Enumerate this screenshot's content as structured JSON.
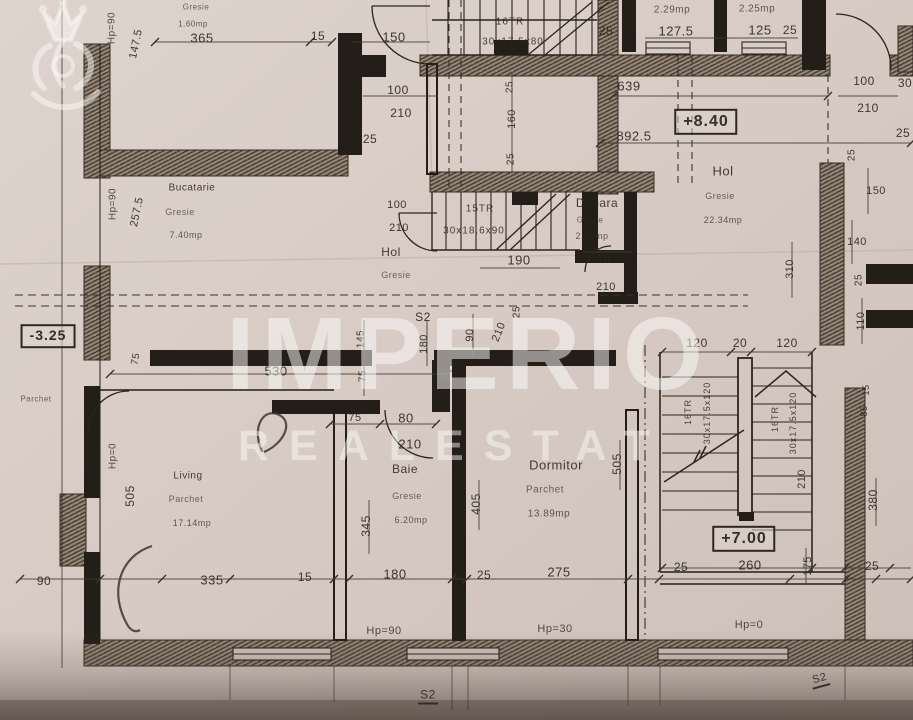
{
  "document": {
    "type": "scanned floor plan (etaj) photo"
  },
  "watermark": {
    "brand": "IMPERIO",
    "brand_sub": "REALESTAT",
    "logo": "crown-lion-icon"
  },
  "rooms": [
    {
      "name": "Bucatarie",
      "finish": "Gresie",
      "area": "7.40mp"
    },
    {
      "name": "Hol",
      "finish": "Gresie",
      "area": ""
    },
    {
      "name": "Debara",
      "finish": "Gresie",
      "area": "2.10mp"
    },
    {
      "name": "Hol",
      "finish": "Gresie",
      "area": "22.34mp"
    },
    {
      "name": "Living",
      "finish": "Parchet",
      "area": "17.14mp"
    },
    {
      "name": "Baie",
      "finish": "Gresie",
      "area": "6.20mp"
    },
    {
      "name": "Dormitor",
      "finish": "Parchet",
      "area": "13.89mp"
    }
  ],
  "elevations": [
    "+8.40",
    "+7.00",
    "-3.25"
  ],
  "stairs": [
    {
      "label": "16TR 30x17.5x80"
    },
    {
      "label": "15TR 30x18.6x90"
    },
    {
      "label": "16TR 30x17.5x120"
    },
    {
      "label": "16TR 30x17.5x120"
    }
  ],
  "labels": [
    {
      "t": "Hp=90",
      "x": 112,
      "y": 28,
      "r": -90,
      "s": 10,
      "c": "hp"
    },
    {
      "t": "147.5",
      "x": 136,
      "y": 44,
      "r": -78,
      "s": 11
    },
    {
      "t": "Gresie",
      "x": 196,
      "y": 7,
      "s": 8,
      "c": "fin"
    },
    {
      "t": "1.60mp",
      "x": 193,
      "y": 24,
      "s": 8,
      "c": "area"
    },
    {
      "t": "365",
      "x": 202,
      "y": 38,
      "s": 13
    },
    {
      "t": "15",
      "x": 318,
      "y": 36,
      "s": 12
    },
    {
      "t": "150",
      "x": 394,
      "y": 37,
      "s": 13
    },
    {
      "t": "16TR",
      "x": 510,
      "y": 22,
      "s": 10,
      "c": "stair"
    },
    {
      "t": "30x17.5x80",
      "x": 513,
      "y": 42,
      "s": 10,
      "c": "stair"
    },
    {
      "t": "25",
      "x": 606,
      "y": 31,
      "s": 12
    },
    {
      "t": "2.29mp",
      "x": 672,
      "y": 10,
      "s": 10,
      "c": "area"
    },
    {
      "t": "127.5",
      "x": 676,
      "y": 31,
      "s": 13
    },
    {
      "t": "2.25mp",
      "x": 757,
      "y": 9,
      "s": 10,
      "c": "area"
    },
    {
      "t": "125",
      "x": 760,
      "y": 30,
      "s": 13
    },
    {
      "t": "25",
      "x": 790,
      "y": 30,
      "s": 12
    },
    {
      "t": "100",
      "x": 398,
      "y": 90,
      "s": 12
    },
    {
      "t": "210",
      "x": 401,
      "y": 113,
      "s": 12
    },
    {
      "t": "25",
      "x": 370,
      "y": 139,
      "s": 12
    },
    {
      "t": "25",
      "x": 510,
      "y": 87,
      "r": -90,
      "s": 10
    },
    {
      "t": "160",
      "x": 512,
      "y": 119,
      "r": -90,
      "s": 11
    },
    {
      "t": "25",
      "x": 511,
      "y": 159,
      "r": -90,
      "s": 10
    },
    {
      "t": "639",
      "x": 629,
      "y": 86,
      "s": 13
    },
    {
      "t": "892.5",
      "x": 634,
      "y": 136,
      "s": 13
    },
    {
      "t": "+8.40",
      "x": 706,
      "y": 122,
      "s": 16,
      "c": "box"
    },
    {
      "t": "100",
      "x": 864,
      "y": 81,
      "s": 12
    },
    {
      "t": "30",
      "x": 905,
      "y": 83,
      "s": 12
    },
    {
      "t": "210",
      "x": 868,
      "y": 108,
      "s": 12
    },
    {
      "t": "25",
      "x": 903,
      "y": 133,
      "s": 12
    },
    {
      "t": "25",
      "x": 852,
      "y": 155,
      "r": -90,
      "s": 10
    },
    {
      "t": "Hol",
      "x": 723,
      "y": 171,
      "s": 13,
      "c": "room"
    },
    {
      "t": "Gresie",
      "x": 720,
      "y": 196,
      "s": 9,
      "c": "fin"
    },
    {
      "t": "22.34mp",
      "x": 723,
      "y": 220,
      "s": 9,
      "c": "area"
    },
    {
      "t": "150",
      "x": 876,
      "y": 191,
      "s": 11
    },
    {
      "t": "140",
      "x": 857,
      "y": 242,
      "s": 11
    },
    {
      "t": "310",
      "x": 790,
      "y": 269,
      "r": -90,
      "s": 11
    },
    {
      "t": "25",
      "x": 859,
      "y": 280,
      "r": -90,
      "s": 10
    },
    {
      "t": "110",
      "x": 861,
      "y": 321,
      "r": -90,
      "s": 11
    },
    {
      "t": "15TR",
      "x": 480,
      "y": 209,
      "s": 10,
      "c": "stair"
    },
    {
      "t": "30x18.6x90",
      "x": 474,
      "y": 231,
      "s": 10,
      "c": "stair"
    },
    {
      "t": "190",
      "x": 519,
      "y": 260,
      "s": 13
    },
    {
      "t": "Debara",
      "x": 597,
      "y": 203,
      "s": 12,
      "c": "room"
    },
    {
      "t": "Gresie",
      "x": 590,
      "y": 220,
      "s": 8,
      "c": "fin"
    },
    {
      "t": "2.10mp",
      "x": 592,
      "y": 236,
      "s": 9,
      "c": "area"
    },
    {
      "t": "70",
      "x": 604,
      "y": 259,
      "s": 11
    },
    {
      "t": "210",
      "x": 606,
      "y": 287,
      "s": 11
    },
    {
      "t": "Hol",
      "x": 391,
      "y": 252,
      "s": 12,
      "c": "room"
    },
    {
      "t": "Gresie",
      "x": 396,
      "y": 275,
      "s": 9,
      "c": "fin"
    },
    {
      "t": "100",
      "x": 397,
      "y": 205,
      "s": 11
    },
    {
      "t": "210",
      "x": 399,
      "y": 228,
      "s": 11
    },
    {
      "t": "S2",
      "x": 423,
      "y": 317,
      "s": 12,
      "c": "sec"
    },
    {
      "t": "180",
      "x": 424,
      "y": 344,
      "r": -90,
      "s": 11
    },
    {
      "t": "90",
      "x": 470,
      "y": 335,
      "r": -90,
      "s": 11
    },
    {
      "t": "210",
      "x": 499,
      "y": 332,
      "r": -68,
      "s": 11
    },
    {
      "t": "25",
      "x": 517,
      "y": 312,
      "r": -90,
      "s": 10
    },
    {
      "t": "145",
      "x": 361,
      "y": 339,
      "r": -90,
      "s": 10
    },
    {
      "t": "75",
      "x": 363,
      "y": 376,
      "r": -90,
      "s": 10
    },
    {
      "t": "530",
      "x": 276,
      "y": 371,
      "s": 13
    },
    {
      "t": "Hp=90",
      "x": 113,
      "y": 204,
      "r": -90,
      "s": 10,
      "c": "hp"
    },
    {
      "t": "257.5",
      "x": 137,
      "y": 212,
      "r": -78,
      "s": 11
    },
    {
      "t": "Bucatarie",
      "x": 192,
      "y": 188,
      "s": 10,
      "c": "room"
    },
    {
      "t": "Gresie",
      "x": 180,
      "y": 212,
      "s": 9,
      "c": "fin"
    },
    {
      "t": "7.40mp",
      "x": 186,
      "y": 235,
      "s": 9,
      "c": "area"
    },
    {
      "t": "-3.25",
      "x": 48,
      "y": 336,
      "s": 14,
      "c": "box"
    },
    {
      "t": "75",
      "x": 136,
      "y": 359,
      "r": -80,
      "s": 10
    },
    {
      "t": "Parchet",
      "x": 36,
      "y": 399,
      "s": 8,
      "c": "fin"
    },
    {
      "t": "Hp=0",
      "x": 113,
      "y": 456,
      "r": -90,
      "s": 10,
      "c": "hp"
    },
    {
      "t": "505",
      "x": 130,
      "y": 496,
      "r": -90,
      "s": 12
    },
    {
      "t": "Living",
      "x": 188,
      "y": 476,
      "s": 10,
      "c": "room"
    },
    {
      "t": "Parchet",
      "x": 186,
      "y": 499,
      "s": 9,
      "c": "fin"
    },
    {
      "t": "17.14mp",
      "x": 192,
      "y": 523,
      "s": 9,
      "c": "area"
    },
    {
      "t": "90",
      "x": 44,
      "y": 581,
      "s": 12
    },
    {
      "t": "335",
      "x": 212,
      "y": 580,
      "s": 13
    },
    {
      "t": "15",
      "x": 305,
      "y": 577,
      "s": 12
    },
    {
      "t": "75",
      "x": 355,
      "y": 418,
      "s": 11
    },
    {
      "t": "80",
      "x": 406,
      "y": 418,
      "s": 13
    },
    {
      "t": "210",
      "x": 410,
      "y": 444,
      "s": 13
    },
    {
      "t": "Baie",
      "x": 405,
      "y": 469,
      "s": 12,
      "c": "room"
    },
    {
      "t": "Gresie",
      "x": 407,
      "y": 496,
      "s": 9,
      "c": "fin"
    },
    {
      "t": "6.20mp",
      "x": 411,
      "y": 520,
      "s": 9,
      "c": "area"
    },
    {
      "t": "345",
      "x": 366,
      "y": 526,
      "r": -90,
      "s": 12
    },
    {
      "t": "405",
      "x": 476,
      "y": 504,
      "r": -90,
      "s": 12
    },
    {
      "t": "Dormitor",
      "x": 556,
      "y": 465,
      "s": 13,
      "c": "room"
    },
    {
      "t": "Parchet",
      "x": 545,
      "y": 490,
      "s": 10,
      "c": "fin"
    },
    {
      "t": "13.89mp",
      "x": 549,
      "y": 514,
      "s": 10,
      "c": "area"
    },
    {
      "t": "505",
      "x": 617,
      "y": 464,
      "r": -90,
      "s": 12
    },
    {
      "t": "180",
      "x": 395,
      "y": 574,
      "s": 13
    },
    {
      "t": "25",
      "x": 484,
      "y": 575,
      "s": 12
    },
    {
      "t": "275",
      "x": 559,
      "y": 572,
      "s": 13
    },
    {
      "t": "Hp=90",
      "x": 384,
      "y": 631,
      "s": 11,
      "c": "hp"
    },
    {
      "t": "Hp=30",
      "x": 555,
      "y": 629,
      "s": 11,
      "c": "hp"
    },
    {
      "t": "120",
      "x": 697,
      "y": 343,
      "s": 12
    },
    {
      "t": "20",
      "x": 740,
      "y": 343,
      "s": 12
    },
    {
      "t": "120",
      "x": 787,
      "y": 343,
      "s": 12
    },
    {
      "t": "16TR",
      "x": 688,
      "y": 412,
      "r": -90,
      "s": 9,
      "c": "stair"
    },
    {
      "t": "30x17.5x120",
      "x": 707,
      "y": 413,
      "r": -90,
      "s": 9,
      "c": "stair"
    },
    {
      "t": "16TR",
      "x": 775,
      "y": 419,
      "r": -90,
      "s": 9,
      "c": "stair"
    },
    {
      "t": "30x17.5x120",
      "x": 793,
      "y": 423,
      "r": -90,
      "s": 9,
      "c": "stair"
    },
    {
      "t": "210",
      "x": 802,
      "y": 479,
      "r": -90,
      "s": 11
    },
    {
      "t": "15",
      "x": 866,
      "y": 390,
      "r": -90,
      "s": 9
    },
    {
      "t": "85",
      "x": 864,
      "y": 411,
      "r": -90,
      "s": 9
    },
    {
      "t": "380",
      "x": 873,
      "y": 500,
      "r": -90,
      "s": 12
    },
    {
      "t": "+7.00",
      "x": 744,
      "y": 539,
      "s": 16,
      "c": "box"
    },
    {
      "t": "260",
      "x": 750,
      "y": 565,
      "s": 13
    },
    {
      "t": "25",
      "x": 681,
      "y": 567,
      "s": 12
    },
    {
      "t": "175",
      "x": 808,
      "y": 566,
      "r": -90,
      "s": 11
    },
    {
      "t": "25",
      "x": 872,
      "y": 566,
      "s": 12
    },
    {
      "t": "Hp=0",
      "x": 749,
      "y": 625,
      "s": 11,
      "c": "hp"
    },
    {
      "t": "S2",
      "x": 428,
      "y": 696,
      "s": 12,
      "c": "secu"
    },
    {
      "t": "S2",
      "x": 820,
      "y": 680,
      "r": -15,
      "s": 11,
      "c": "secu"
    }
  ]
}
